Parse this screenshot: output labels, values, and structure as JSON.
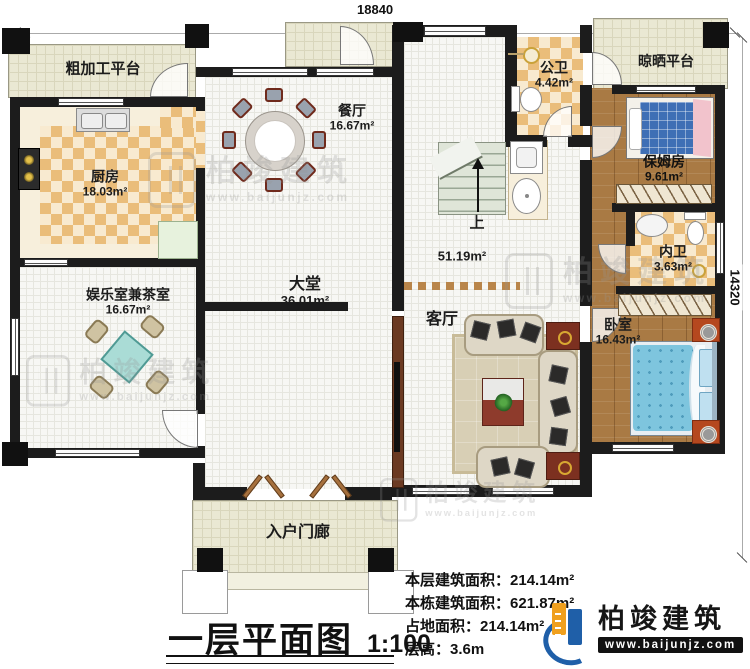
{
  "dimensions": {
    "width_label": "18840",
    "height_label": "14320"
  },
  "rooms": {
    "rough_platform": {
      "name": "粗加工平台"
    },
    "kitchen": {
      "name": "厨房",
      "area": "18.03m²"
    },
    "dining": {
      "name": "餐厅",
      "area": "16.67m²"
    },
    "public_bath": {
      "name": "公卫",
      "area": "4.42m²"
    },
    "drying_platform": {
      "name": "晾晒平台"
    },
    "nanny_room": {
      "name": "保姆房",
      "area": "9.61m²"
    },
    "inner_bath": {
      "name": "内卫",
      "area": "3.63m²"
    },
    "bedroom": {
      "name": "卧室",
      "area": "16.43m²"
    },
    "tea_room": {
      "name": "娱乐室兼茶室",
      "area": "16.67m²"
    },
    "hall": {
      "name": "大堂",
      "area": "36.01m²",
      "area_open": "51.19m²"
    },
    "living": {
      "name": "客厅"
    },
    "stairs": {
      "up": "上"
    },
    "porch": {
      "name": "入户门廊"
    }
  },
  "title": {
    "text": "一层平面图",
    "scale": "1:100"
  },
  "stats": [
    {
      "label": "本层建筑面积：",
      "value": "214.14m²"
    },
    {
      "label": "本栋建筑面积：",
      "value": "621.87m²"
    },
    {
      "label": "占地面积：",
      "value": "214.14m²"
    },
    {
      "label": "层高：",
      "value": "3.6m"
    }
  ],
  "brand": {
    "name": "柏竣建筑",
    "url": "www.baijunjz.com"
  },
  "watermark": {
    "name": "柏竣建筑",
    "url": "www.baijunjz.com"
  },
  "colors": {
    "wall": "#1c1c1c",
    "checker_tile": "#eabd7a",
    "wood": "#a97a44",
    "platform": "#eae8d3",
    "brand_blue": "#1f5fa8",
    "brand_orange": "#f0a01e"
  }
}
